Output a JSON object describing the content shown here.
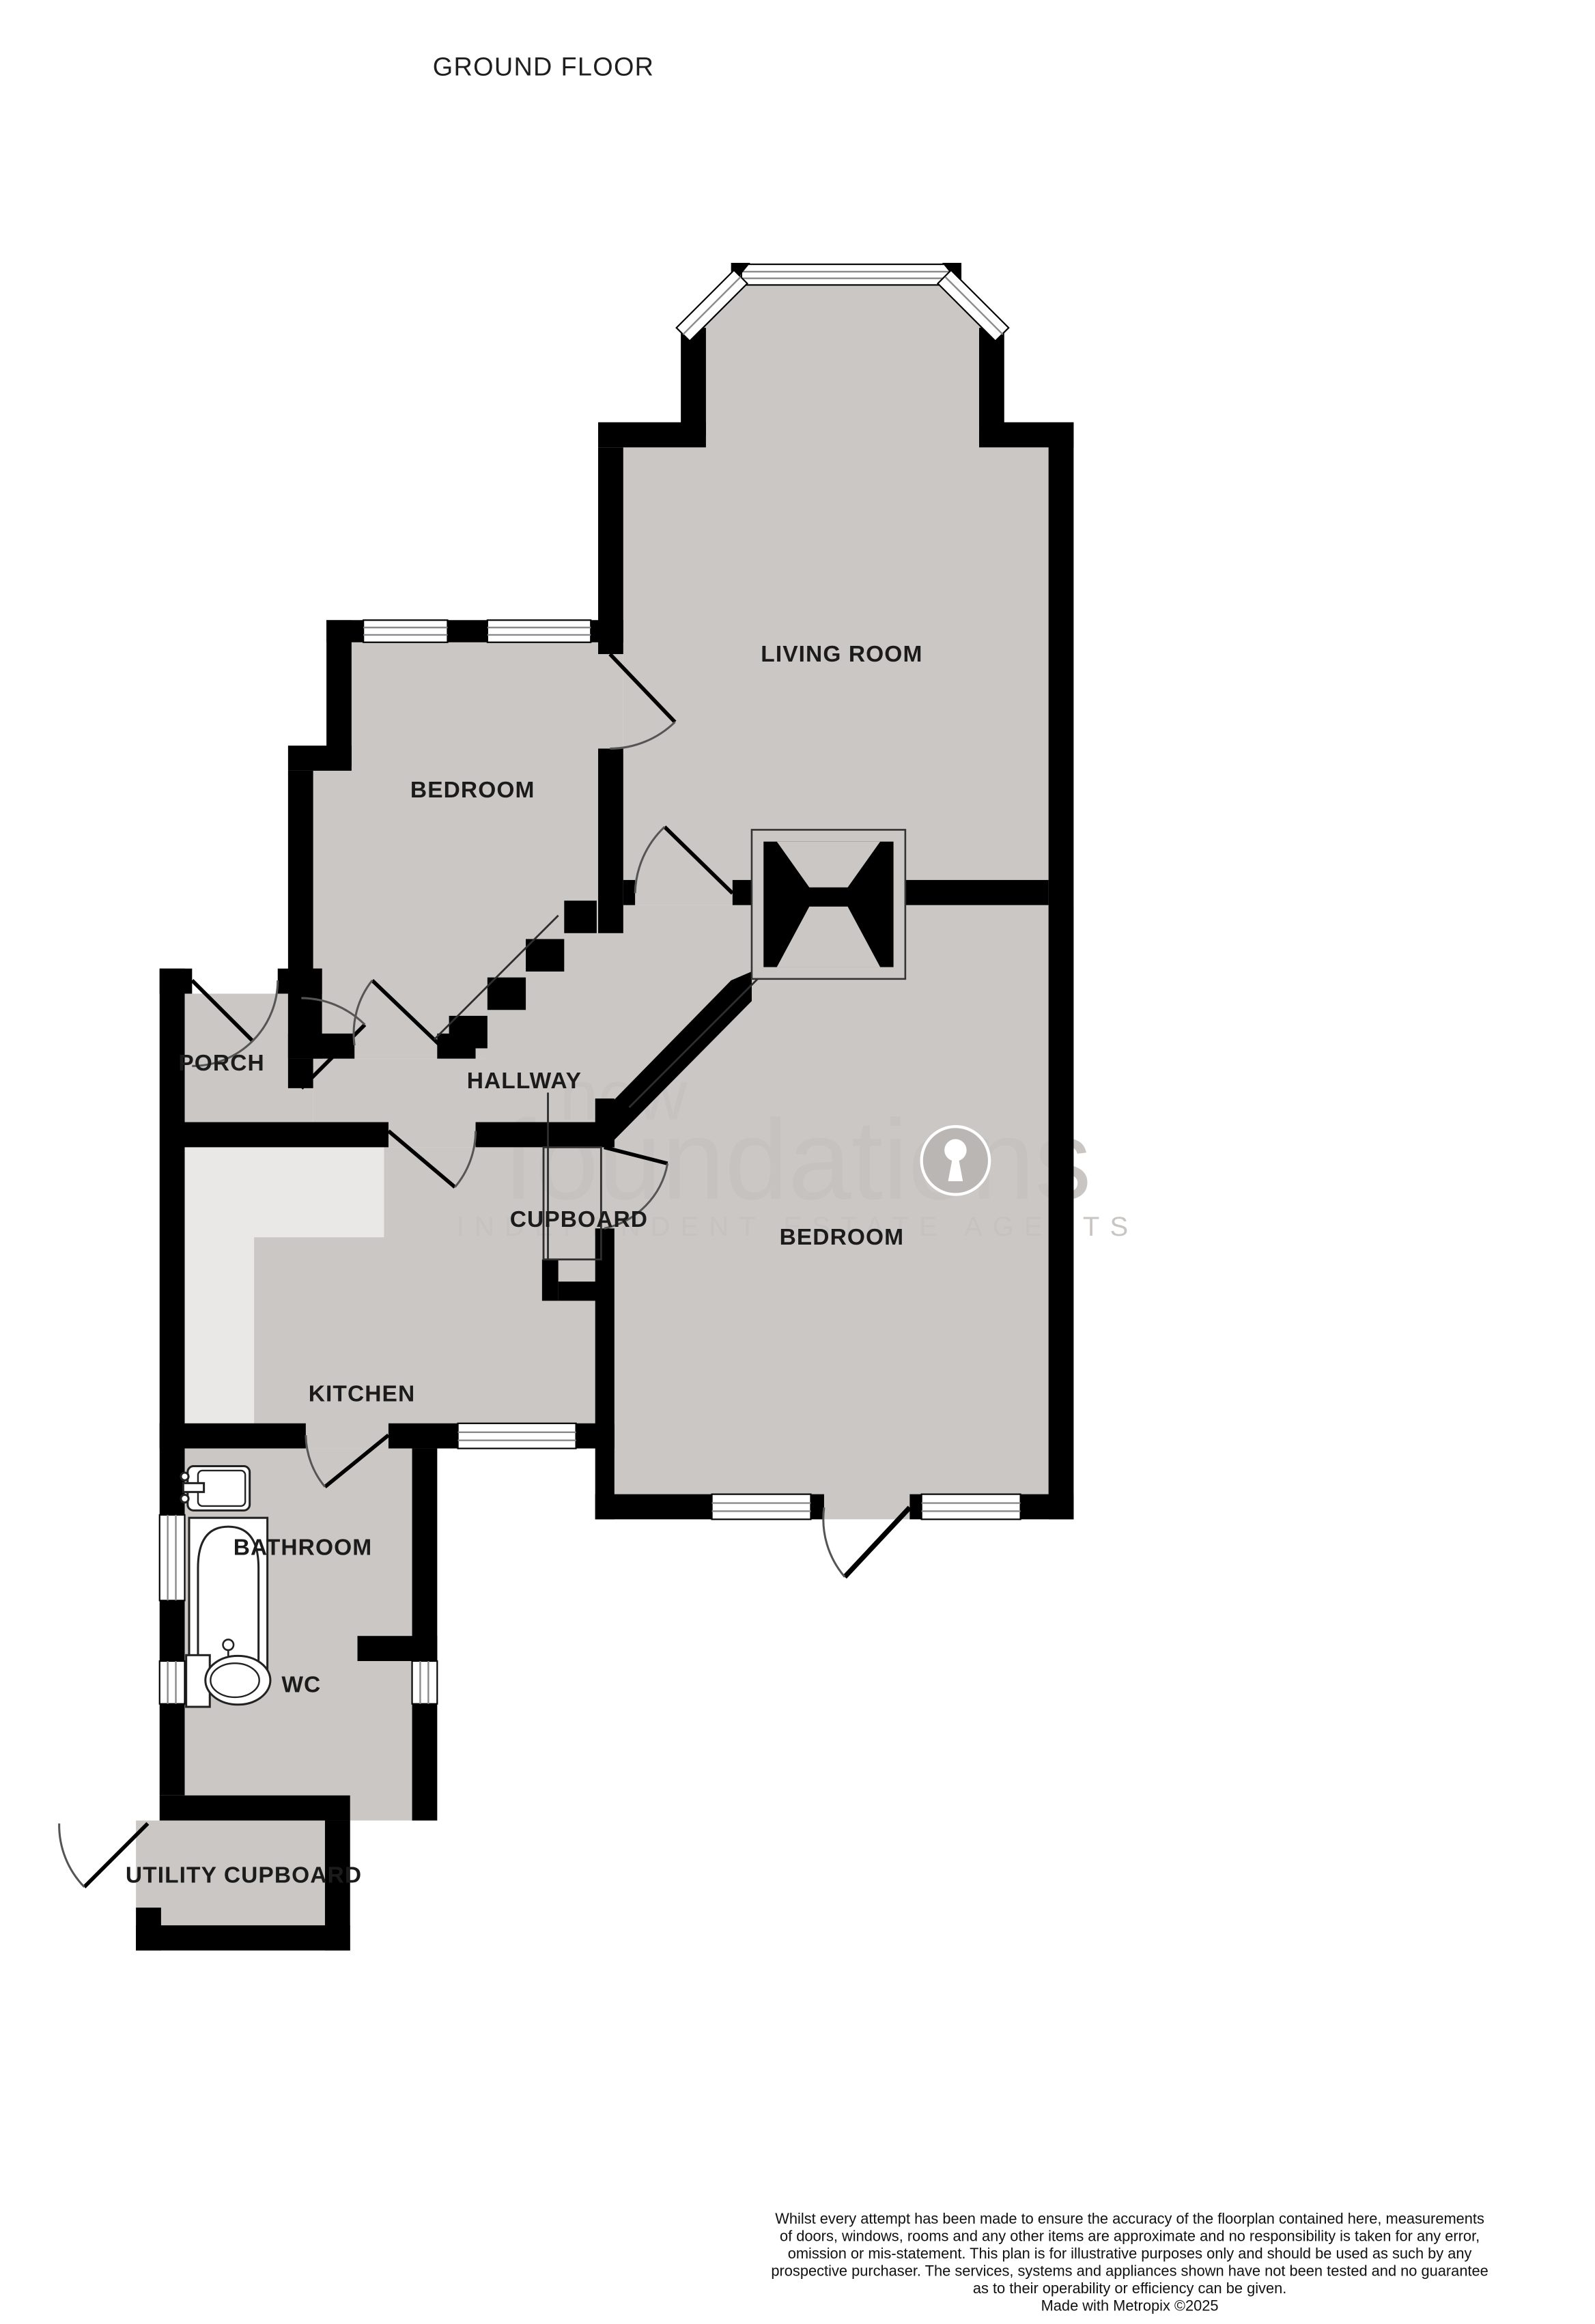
{
  "title": "GROUND FLOOR",
  "labels": {
    "living_room": "LIVING ROOM",
    "bedroom_top": "BEDROOM",
    "bedroom_right": "BEDROOM",
    "hallway": "HALLWAY",
    "porch": "PORCH",
    "cupboard": "CUPBOARD",
    "kitchen": "KITCHEN",
    "bathroom": "BATHROOM",
    "wc": "WC",
    "utility": "UTILITY CUPBOARD"
  },
  "watermark": {
    "brand_line1": "new",
    "brand_line2": "foundations",
    "tagline": "INDEPENDENT ESTATE AGENTS"
  },
  "footer": {
    "lines": [
      "Whilst every attempt has been made to ensure the accuracy of the floorplan contained here, measurements",
      "of doors, windows, rooms and any other items are approximate and no responsibility is taken for any error,",
      "omission or mis-statement. This plan is for illustrative purposes only and should be used as such by any",
      "prospective purchaser. The services, systems and appliances shown have not been tested and no guarantee",
      "as to their operability or efficiency can be given.",
      "Made with Metropix ©2025"
    ]
  },
  "colors": {
    "floor": "#cbc7c4",
    "counter": "#eae8e6",
    "wall": "#000000",
    "mullion": "#8a8a8a",
    "watermark": "#c6c2bf",
    "label": "#1b1b1b"
  }
}
